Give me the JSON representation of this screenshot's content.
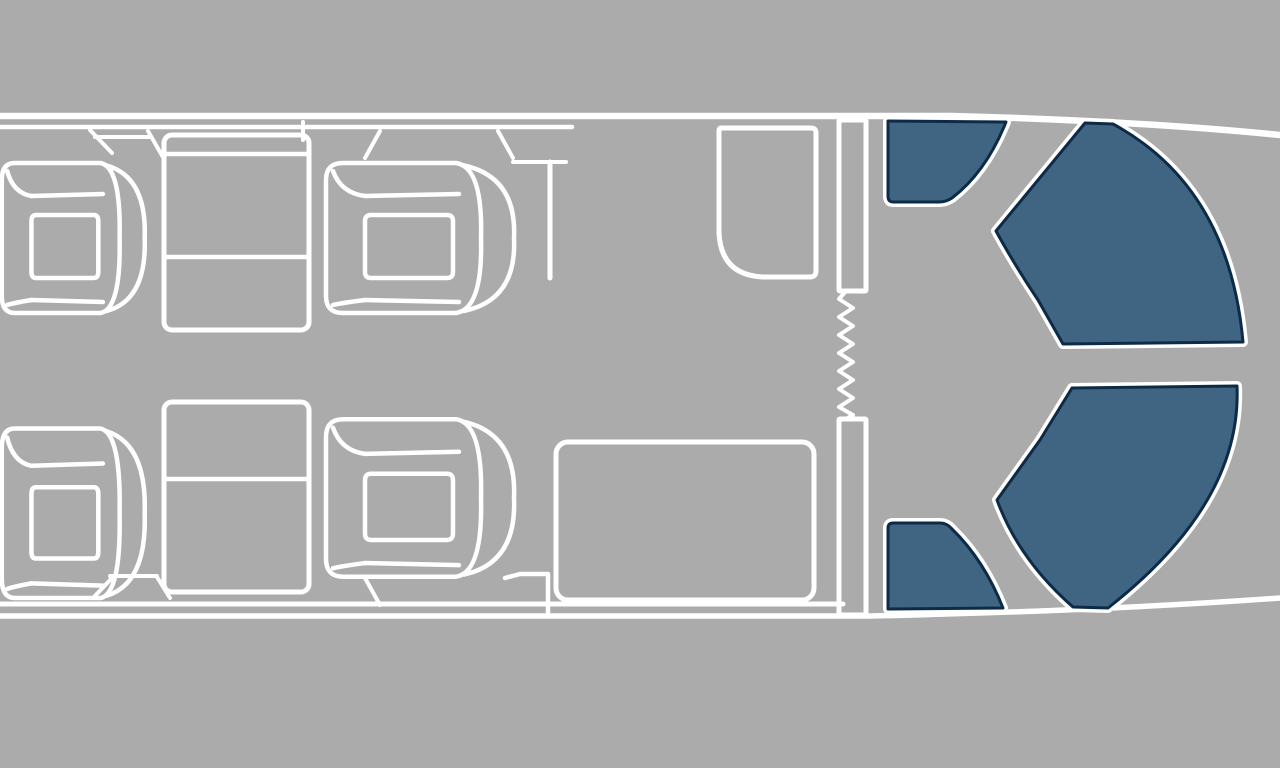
{
  "colors": {
    "background": "#ABABAB",
    "outline": "#FFFFFF",
    "highlight_seat_fill": "#3F6583",
    "highlight_seat_border": "#0D2B47"
  },
  "floorplan": {
    "viewbox": "0 0 1280 768",
    "hull": [
      {
        "name": "hull-top-outer-line",
        "kind": "path",
        "d": "M0,116 H952 Q1140,121 1280,135",
        "w": 6.5
      },
      {
        "name": "hull-top-inner-line",
        "kind": "path",
        "d": "M0,127 H572",
        "w": 4.5
      },
      {
        "name": "hull-bottom-inner-line",
        "kind": "path",
        "d": "M0,604 H843",
        "w": 5
      },
      {
        "name": "hull-bottom-outer-line",
        "kind": "path",
        "d": "M0,616 H870 Q1100,611 1280,598",
        "w": 5.5
      }
    ],
    "fixtures": [
      {
        "name": "window-bay-line-top-left",
        "kind": "path",
        "d": "M90,130 L112,153",
        "w": 4
      },
      {
        "name": "window-bay-shelf-top",
        "kind": "path",
        "d": "M95,137 H150",
        "w": 4
      },
      {
        "name": "window-bay-line-top-mid",
        "kind": "path",
        "d": "M148,131 L164,159",
        "w": 4
      },
      {
        "name": "table-riser-line",
        "kind": "path",
        "d": "M303,122 V140",
        "w": 4
      },
      {
        "name": "window-bay-line-top-chair2",
        "kind": "path",
        "d": "M365,158 L380,131",
        "w": 4
      },
      {
        "name": "window-bay-line-top-right",
        "kind": "path",
        "d": "M498,131 L513,158",
        "w": 4
      },
      {
        "name": "forward-console-shelf",
        "kind": "path",
        "d": "M513,162 H566",
        "w": 4
      },
      {
        "name": "forward-console-wall",
        "kind": "path",
        "d": "M550,162 V278",
        "w": 5
      },
      {
        "name": "window-bay-line-bottom-left",
        "kind": "path",
        "d": "M93,598 L112,578",
        "w": 4
      },
      {
        "name": "window-bay-shelf-bottom",
        "kind": "path",
        "d": "M110,576 H157",
        "w": 4
      },
      {
        "name": "window-bay-line-bottom-mid",
        "kind": "path",
        "d": "M157,577 L170,598",
        "w": 4
      },
      {
        "name": "window-bay-line-bottom-chair4",
        "kind": "path",
        "d": "M365,578 L380,605",
        "w": 4
      },
      {
        "name": "aft-ledge-wall",
        "kind": "path",
        "d": "M505,578 L520,574 H548 V614",
        "w": 4.5
      },
      {
        "name": "lavatory-cabinet",
        "kind": "path",
        "d": "M721,128 L811,128 Q816,128 816,133 L816,271 Q816,277 810,277 L763,277 Q721,275 719,233 L719,131 Q719,128 721,128 Z",
        "w": 5
      },
      {
        "name": "partition-wall-upper",
        "kind": "rect",
        "x": 839,
        "y": 120,
        "width": 27,
        "height": 171,
        "rx": 1,
        "w": 5
      },
      {
        "name": "partition-wall-lower",
        "kind": "rect",
        "x": 839,
        "y": 419,
        "width": 27,
        "height": 196,
        "rx": 1,
        "w": 5
      },
      {
        "name": "curtain-zigzag",
        "kind": "polyline",
        "points": "846,291 839,299 853,308 839,317 853,326 839,335 853,344 839,353 853,362 839,371 853,380 839,389 853,398 839,407 853,415 846,419",
        "w": 4
      },
      {
        "name": "divan-sofa",
        "kind": "rect",
        "x": 556,
        "y": 442,
        "width": 258,
        "height": 158,
        "rx": 12,
        "w": 5
      },
      {
        "name": "table-forward",
        "kind": "rect",
        "x": 164,
        "y": 135,
        "width": 145,
        "height": 195,
        "rx": 8,
        "w": 5
      },
      {
        "name": "table-forward-fold-line-a",
        "kind": "path",
        "d": "M166,154 H307",
        "w": 4.5
      },
      {
        "name": "table-forward-fold-line-b",
        "kind": "path",
        "d": "M166,257 H307",
        "w": 4.5
      },
      {
        "name": "table-aft",
        "kind": "rect",
        "x": 164,
        "y": 402,
        "width": 145,
        "height": 190,
        "rx": 8,
        "w": 5
      },
      {
        "name": "table-aft-fold-line",
        "kind": "path",
        "d": "M166,479 H307",
        "w": 4.5
      }
    ],
    "club_chair_glyph": [
      {
        "part": "chair-body-outline",
        "d": "M22,4 L135,4 Q162,8 160,79 Q162,150 135,154 L22,154 Q5,154 5,137 L5,21 Q5,4 22,4 Z"
      },
      {
        "part": "chair-backrest-outer-band",
        "d": "M141,6 Q196,17 193,79 Q196,141 143,152"
      },
      {
        "part": "chair-cushion",
        "d": "M50,56 H126 Q132,56 132,62 V113 Q132,119 126,119 H50 Q44,119 44,113 V62 Q44,56 50,56 Z"
      },
      {
        "part": "chair-armrest-seam-top",
        "d": "M44,37 L138,35"
      },
      {
        "part": "chair-armrest-seam-bottom",
        "d": "M44,141 L138,143"
      },
      {
        "part": "chair-corner-seam-top",
        "d": "M44,37 Q20,34 12,12"
      },
      {
        "part": "chair-corner-seam-bottom",
        "d": "M44,141 Q20,144 12,146"
      }
    ],
    "club_chairs": [
      {
        "name": "club-chair-forward-left-top",
        "transform": "translate(-2,159) scale(0.76,1)"
      },
      {
        "name": "club-chair-forward-right-top",
        "transform": "translate(321,159) scale(1,1)"
      },
      {
        "name": "club-chair-forward-left-bottom",
        "transform": "translate(-2,424) scale(0.76,1.13)"
      },
      {
        "name": "club-chair-forward-right-bottom",
        "transform": "translate(321,415) scale(1,1.05)"
      }
    ],
    "highlighted_seats": [
      {
        "name": "aft-seat-top-left",
        "d": "M888,121 L1006,122 Q986,172 952,198 Q946,202 939,202 L893,202 Q888,202 888,196 Z"
      },
      {
        "name": "aft-seat-top-right",
        "d": "M1085,123 L1113,124 Q1229,187 1243,342 L1063,344 L1038,300 Q1014,264 996,231 Z"
      },
      {
        "name": "aft-seat-bottom-right",
        "d": "M1072,388 L1237,386 Q1242,503 1108,608 L1073,607 Q1019,560 997,500 L1040,440 Z"
      },
      {
        "name": "aft-seat-bottom-left",
        "d": "M893,523 L940,523 Q947,523 952,529 Q984,560 1003,608 L888,609 L888,528 Q888,523 893,523 Z"
      }
    ]
  }
}
